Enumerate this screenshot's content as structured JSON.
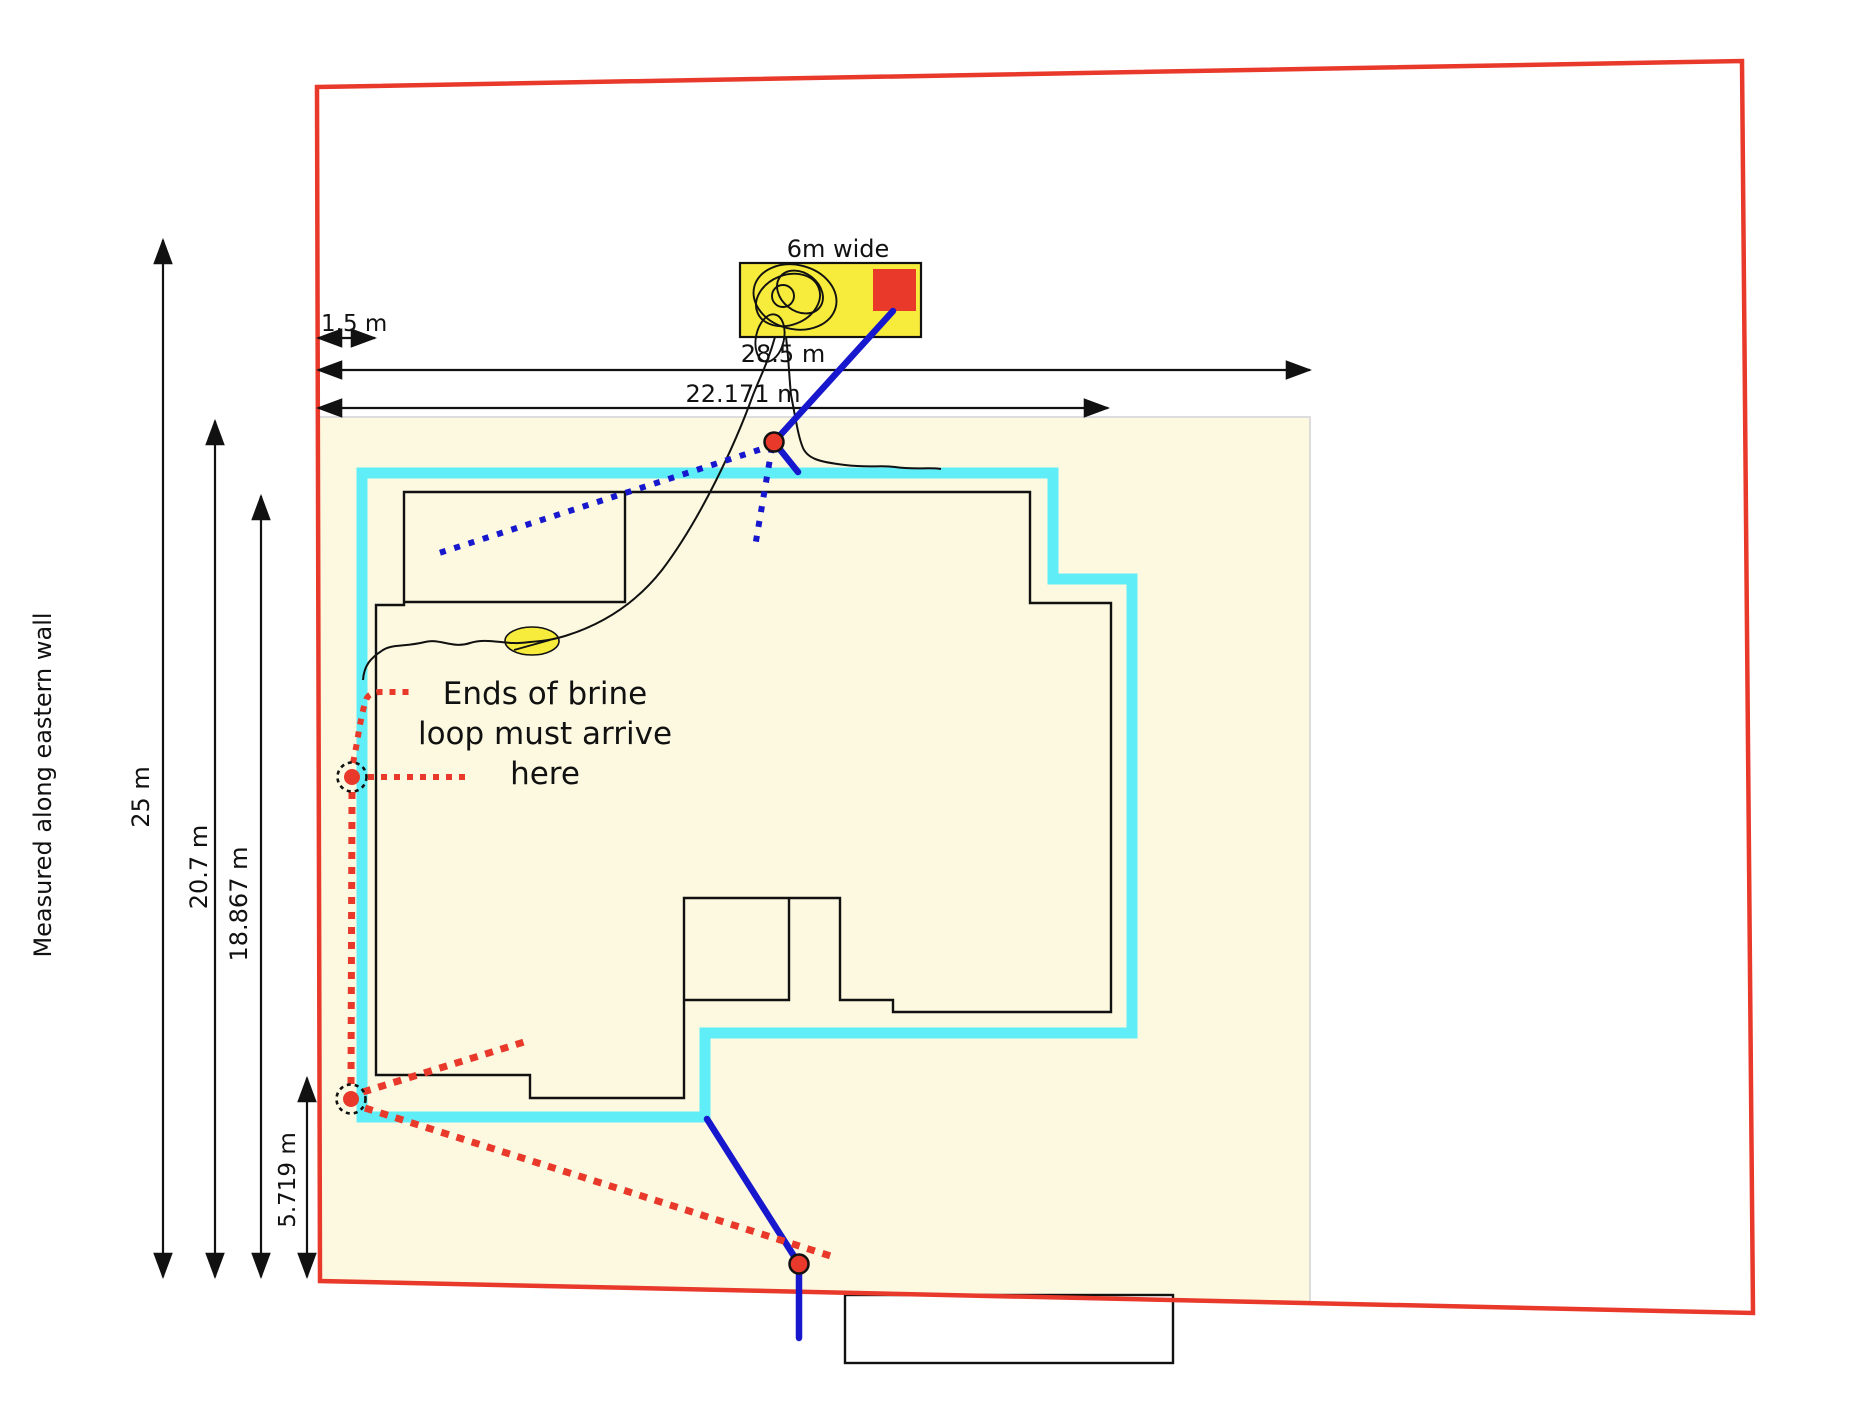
{
  "diagram": {
    "labels": {
      "box_width": "6m wide",
      "dim_28_5": "28.5 m",
      "dim_22_171": "22.171 m",
      "dim_1_5": "1.5 m",
      "dim_25": "25 m",
      "dim_20_7": "20.7 m",
      "dim_18_867": "18.867 m",
      "dim_5_719": "5.719 m",
      "eastern_wall_note": "Measured along eastern wall",
      "annotation_line1": "Ends of brine",
      "annotation_line2": "loop must arrive",
      "annotation_line3": "here"
    },
    "colors": {
      "boundary_red": "#e8392b",
      "house_offset_cyan": "#5fedf8",
      "site_fill_cream": "#fcf9e0",
      "equipment_yellow": "#f7eb3c",
      "pipe_blue": "#1717ce",
      "wall_black": "#111111"
    }
  }
}
